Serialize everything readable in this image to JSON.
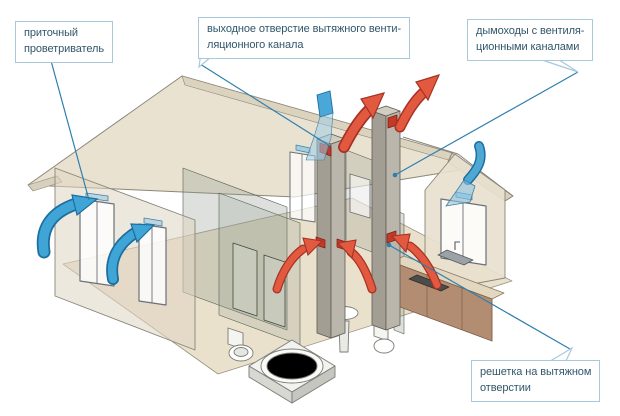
{
  "diagram": {
    "kind": "house-ventilation-cutaway",
    "language": "ru"
  },
  "callouts": {
    "supply_ventilator": {
      "lines": [
        "приточный",
        "проветриватель"
      ]
    },
    "exhaust_duct_outlet": {
      "lines": [
        "выходное отверстие вытяжного венти-",
        "ляционного канала"
      ]
    },
    "chimneys_with_vent_channels": {
      "lines": [
        "дымоходы с вентиля-",
        "ционными каналами"
      ]
    },
    "exhaust_grille": {
      "lines": [
        "решетка на вытяжном",
        "отверстии"
      ]
    }
  },
  "colors": {
    "background": "#ffffff",
    "callout_border": "#a8c9dc",
    "callout_text": "#31566a",
    "callout_line": "#2f7fad",
    "supply_air_arrow": "#3fa5d6",
    "supply_air_arrow_outline": "#1c6e9e",
    "exhaust_air_arrow": "#e2593f",
    "exhaust_air_arrow_outline": "#a53224",
    "roof": "#eae2d1",
    "wall": "#ded5c2",
    "chimney": "#a39e94",
    "grille_red": "#c23a28",
    "kitchen_counter": "#b38d72"
  }
}
